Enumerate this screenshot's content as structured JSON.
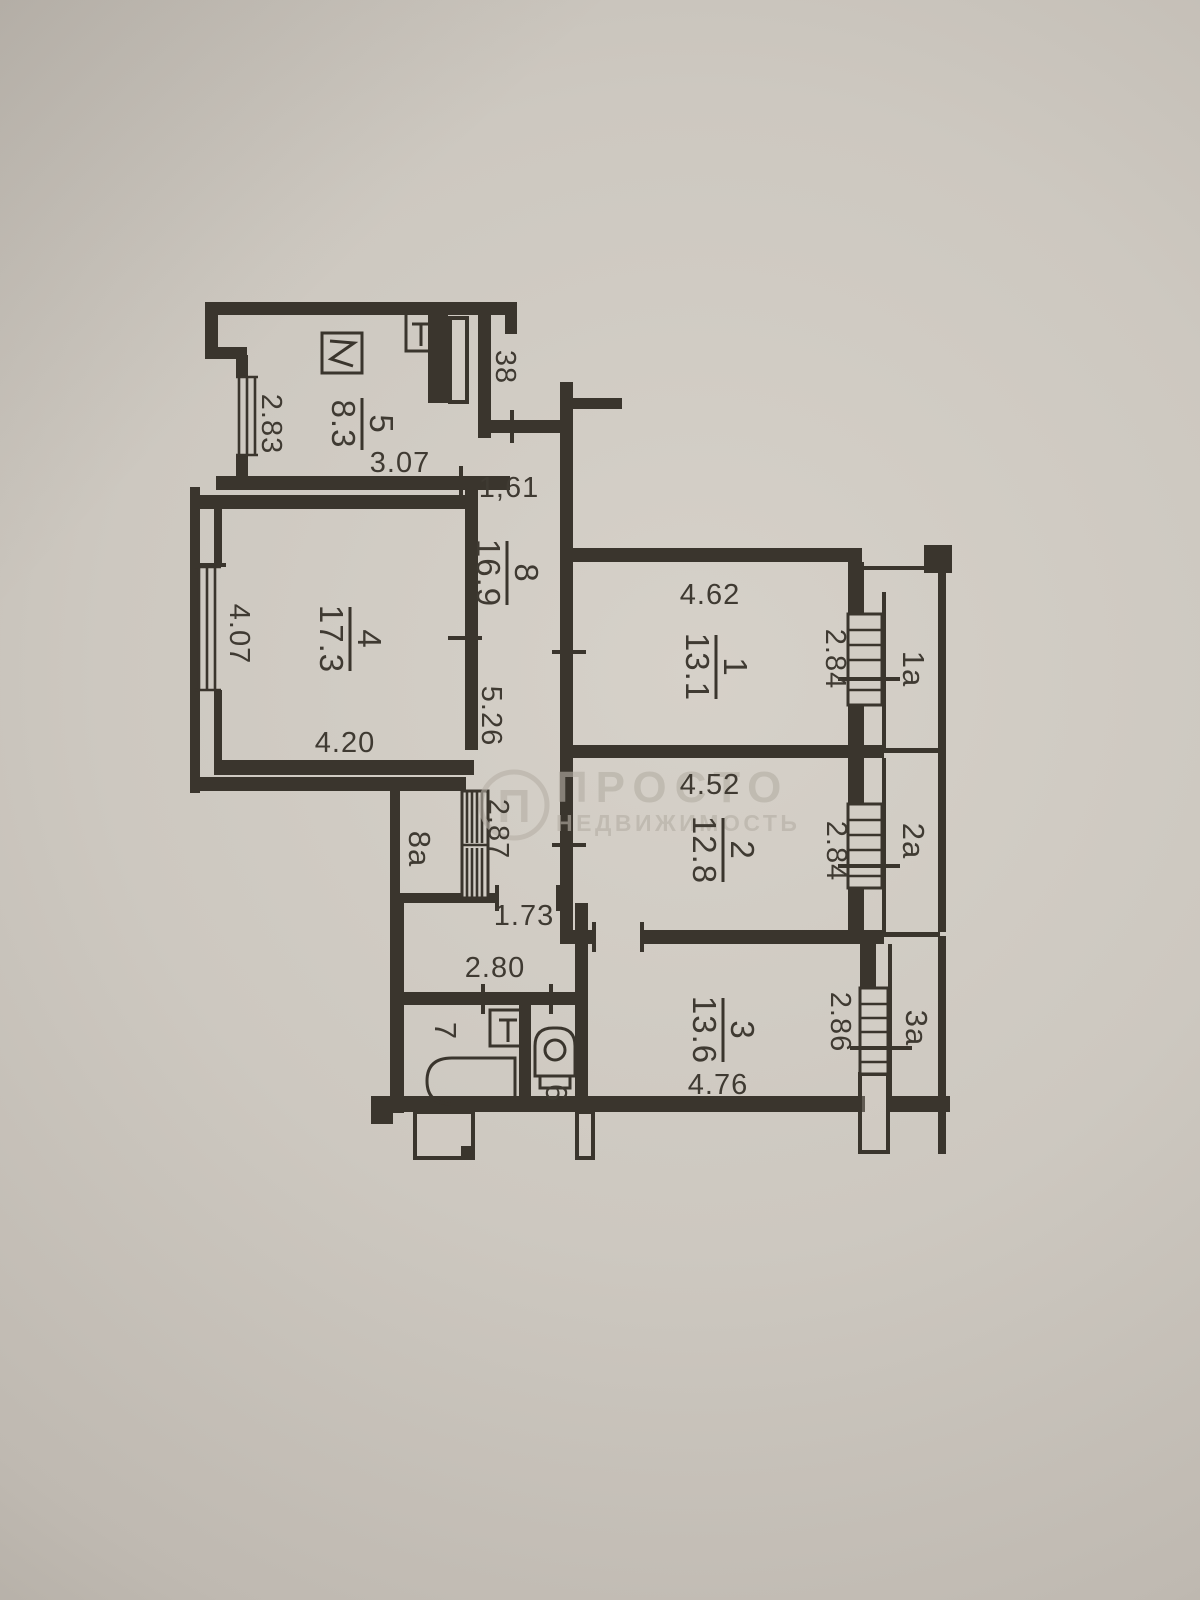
{
  "plan": {
    "apt_number": "38",
    "rooms": {
      "k5": {
        "num": "5",
        "area": "8.3"
      },
      "c8": {
        "num": "8",
        "area": "16.9"
      },
      "r4": {
        "num": "4",
        "area": "17.3"
      },
      "r1": {
        "num": "1",
        "area": "13.1"
      },
      "r2": {
        "num": "2",
        "area": "12.8"
      },
      "r3": {
        "num": "3",
        "area": "13.6"
      },
      "bath7": {
        "num": "7"
      },
      "wc6": {
        "num": "6"
      },
      "st8a": {
        "num": "8а"
      }
    },
    "balconies": {
      "b1": {
        "num": "1а"
      },
      "b2": {
        "num": "2а"
      },
      "b3": {
        "num": "3а"
      }
    },
    "dims": {
      "k5_v": "2.83",
      "k5_h": "3.07",
      "hall_w": "1,61",
      "r4_v": "4.07",
      "r4_h": "4.20",
      "c8_len": "5.26",
      "r1_h": "4.62",
      "r1_v": "2.84",
      "r2_h": "4.52",
      "r2_v": "2.84",
      "r3_v": "2.86",
      "r3_h": "4.76",
      "closet_v": "2.87",
      "lobby_w1": "1.73",
      "lobby_w2": "2.80"
    }
  },
  "watermark": {
    "logo_letter": "П",
    "title": "ПРОСТО",
    "subtitle": "НЕДВИЖИМОСТЬ"
  },
  "colors": {
    "paper": "#cdc8c0",
    "ink": "#3a352d",
    "watermark": "#b5afa5"
  }
}
